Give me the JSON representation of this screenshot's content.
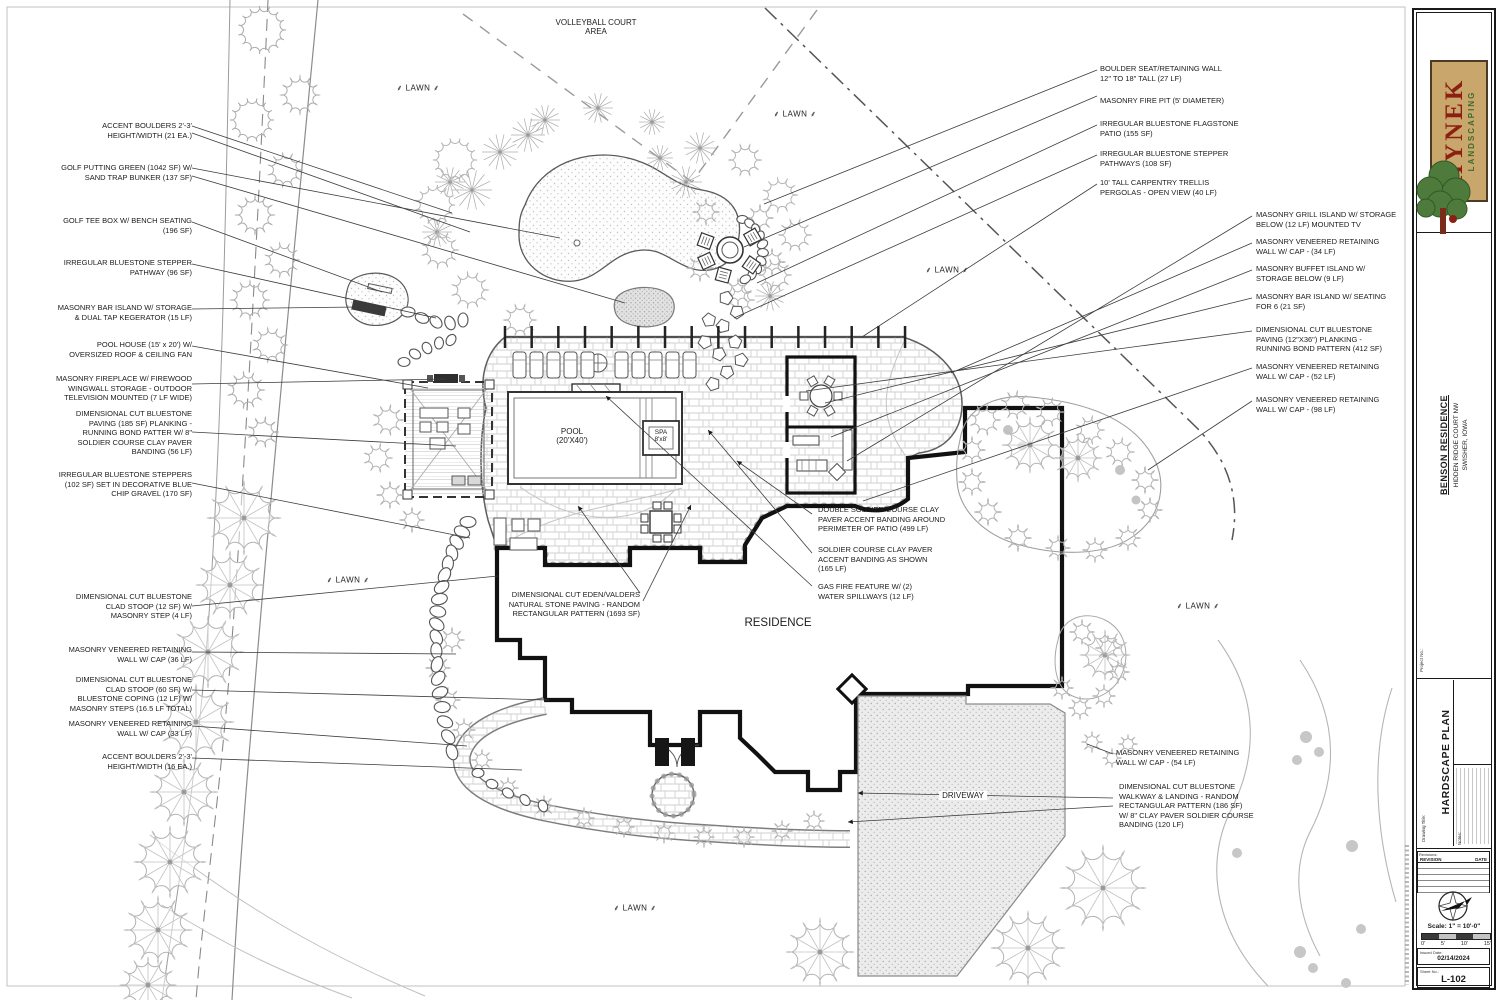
{
  "plan": {
    "lawn_label": "LAWN",
    "lawn_positions": [
      [
        418,
        88
      ],
      [
        795,
        114
      ],
      [
        947,
        270
      ],
      [
        348,
        580
      ],
      [
        1198,
        606
      ],
      [
        635,
        908
      ]
    ],
    "area_labels": [
      {
        "text": "VOLLEYBALL COURT\nAREA",
        "x": 596,
        "y": 18,
        "size": 8,
        "boxed": false
      },
      {
        "text": "POOL\n(20'X40')",
        "x": 572,
        "y": 427,
        "size": 8,
        "boxed": false
      },
      {
        "text": "SPA\n8'x8'",
        "x": 661,
        "y": 429,
        "size": 6.5,
        "boxed": false
      },
      {
        "text": "RESIDENCE",
        "x": 778,
        "y": 617,
        "size": 11.5,
        "boxed": false
      },
      {
        "text": "DRIVEWAY",
        "x": 963,
        "y": 791,
        "size": 8,
        "boxed": true
      }
    ],
    "callouts": [
      {
        "text": "ACCENT BOULDERS 2'-3'\nHEIGHT/WIDTH (21 EA.)",
        "x": 192,
        "y": 121,
        "align": "r"
      },
      {
        "text": "GOLF PUTTING GREEN (1042 SF) W/\nSAND TRAP BUNKER (137 SF)",
        "x": 192,
        "y": 163,
        "align": "r"
      },
      {
        "text": "GOLF TEE BOX W/ BENCH SEATING\n(196 SF)",
        "x": 192,
        "y": 216,
        "align": "r"
      },
      {
        "text": "IRREGULAR BLUESTONE STEPPER\nPATHWAY (96 SF)",
        "x": 192,
        "y": 258,
        "align": "r"
      },
      {
        "text": "MASONRY BAR ISLAND W/ STORAGE\n& DUAL TAP KEGERATOR (15 LF)",
        "x": 192,
        "y": 303,
        "align": "r"
      },
      {
        "text": "POOL HOUSE (15' x 20') W/\nOVERSIZED ROOF & CEILING FAN",
        "x": 192,
        "y": 340,
        "align": "r"
      },
      {
        "text": "MASONRY FIREPLACE W/ FIREWOOD\nWINGWALL STORAGE - OUTDOOR\nTELEVISION MOUNTED (7 LF WIDE)",
        "x": 192,
        "y": 374,
        "align": "r"
      },
      {
        "text": "DIMENSIONAL CUT BLUESTONE\nPAVING (185 SF) PLANKING -\nRUNNING BOND PATTER W/ 8\"\nSOLDIER COURSE CLAY PAVER\nBANDING (56 LF)",
        "x": 192,
        "y": 409,
        "align": "r"
      },
      {
        "text": "IRREGULAR BLUESTONE STEPPERS\n(102 SF) SET IN DECORATIVE BLUE\nCHIP GRAVEL (170 SF)",
        "x": 192,
        "y": 470,
        "align": "r"
      },
      {
        "text": "DIMENSIONAL CUT BLUESTONE\nCLAD STOOP (12 SF) W/\nMASONRY STEP (4 LF)",
        "x": 192,
        "y": 592,
        "align": "r"
      },
      {
        "text": "MASONRY VENEERED RETAINING\nWALL W/ CAP (36 LF)",
        "x": 192,
        "y": 645,
        "align": "r"
      },
      {
        "text": "DIMENSIONAL CUT BLUESTONE\nCLAD STOOP (60 SF) W/\nBLUESTONE COPING (12 LF) W/\nMASONRY STEPS (16.5 LF TOTAL)",
        "x": 192,
        "y": 675,
        "align": "r"
      },
      {
        "text": "MASONRY VENEERED RETAINING\nWALL W/ CAP (33 LF)",
        "x": 192,
        "y": 719,
        "align": "r"
      },
      {
        "text": "ACCENT BOULDERS 2'-3'\nHEIGHT/WIDTH (16 EA.)",
        "x": 192,
        "y": 752,
        "align": "r"
      },
      {
        "text": "BOULDER SEAT/RETAINING WALL\n12\" TO 18\" TALL (27 LF)",
        "x": 1100,
        "y": 64,
        "align": "l"
      },
      {
        "text": "MASONRY FIRE PIT (5' DIAMETER)",
        "x": 1100,
        "y": 96,
        "align": "l"
      },
      {
        "text": "IRREGULAR BLUESTONE FLAGSTONE\nPATIO (155 SF)",
        "x": 1100,
        "y": 119,
        "align": "l"
      },
      {
        "text": "IRREGULAR BLUESTONE STEPPER\nPATHWAYS (108 SF)",
        "x": 1100,
        "y": 149,
        "align": "l"
      },
      {
        "text": "10' TALL CARPENTRY TRELLIS\nPERGOLAS - OPEN VIEW (40 LF)",
        "x": 1100,
        "y": 178,
        "align": "l"
      },
      {
        "text": "MASONRY GRILL ISLAND W/ STORAGE\nBELOW (12 LF) MOUNTED TV",
        "x": 1256,
        "y": 210,
        "align": "l"
      },
      {
        "text": "MASONRY VENEERED RETAINING\nWALL W/ CAP - (34 LF)",
        "x": 1256,
        "y": 237,
        "align": "l"
      },
      {
        "text": "MASONRY BUFFET ISLAND W/\nSTORAGE BELOW (9 LF)",
        "x": 1256,
        "y": 264,
        "align": "l"
      },
      {
        "text": "MASONRY BAR ISLAND W/ SEATING\nFOR 6 (21 SF)",
        "x": 1256,
        "y": 292,
        "align": "l"
      },
      {
        "text": "DIMENSIONAL CUT BLUESTONE\nPAVING (12\"X36\") PLANKING -\nRUNNING BOND PATTERN (412 SF)",
        "x": 1256,
        "y": 325,
        "align": "l"
      },
      {
        "text": "MASONRY VENEERED RETAINING\nWALL W/ CAP - (52 LF)",
        "x": 1256,
        "y": 362,
        "align": "l"
      },
      {
        "text": "MASONRY VENEERED RETAINING\nWALL W/ CAP - (98 LF)",
        "x": 1256,
        "y": 395,
        "align": "l"
      },
      {
        "text": "DOUBLE SOLDIER COURSE CLAY\nPAVER ACCENT BANDING AROUND\nPERIMETER OF PATIO (499 LF)",
        "x": 818,
        "y": 505,
        "align": "l"
      },
      {
        "text": "SOLDIER COURSE CLAY PAVER\nACCENT BANDING AS SHOWN\n(165 LF)",
        "x": 818,
        "y": 545,
        "align": "l"
      },
      {
        "text": "GAS FIRE FEATURE W/ (2)\nWATER SPILLWAYS (12 LF)",
        "x": 818,
        "y": 582,
        "align": "l"
      },
      {
        "text": "DIMENSIONAL CUT EDEN/VALDERS\nNATURAL STONE PAVING - RANDOM\nRECTANGULAR PATTERN (1693 SF)",
        "x": 640,
        "y": 590,
        "align": "r"
      },
      {
        "text": "MASONRY VENEERED RETAINING\nWALL W/ CAP - (54 LF)",
        "x": 1116,
        "y": 748,
        "align": "l"
      },
      {
        "text": "DIMENSIONAL CUT BLUESTONE\nWALKWAY & LANDING - RANDOM\nRECTANGULAR PATTERN (186 SF)\nW/ 8\" CLAY PAVER SOLDIER COURSE\nBANDING (120 LF)",
        "x": 1119,
        "y": 782,
        "align": "l"
      }
    ]
  },
  "titleblock": {
    "brand": {
      "name": "HYNEK",
      "tagline": "LANDSCAPING"
    },
    "project": {
      "title": "BENSON RESIDENCE",
      "address": "HIDDEN RIDGE COURT NW\nSWISHER, IOWA",
      "project_no_label": "Project No.:"
    },
    "drawing": {
      "title": "HARDSCAPE PLAN",
      "title_label": "Drawing Title:",
      "notes_label": "Notes:"
    },
    "revisions": {
      "label": "Revisions:",
      "col_revision": "REVISION",
      "col_date": "DATE"
    },
    "scale": {
      "text": "Scale: 1\" = 10'-0\"",
      "ticks": [
        "0'",
        "5'",
        "10'",
        "15'"
      ]
    },
    "issued": {
      "label": "Issued Date:",
      "value": "02/14/2024"
    },
    "sheet": {
      "label": "Sheet No.:",
      "value": "L-102"
    }
  }
}
